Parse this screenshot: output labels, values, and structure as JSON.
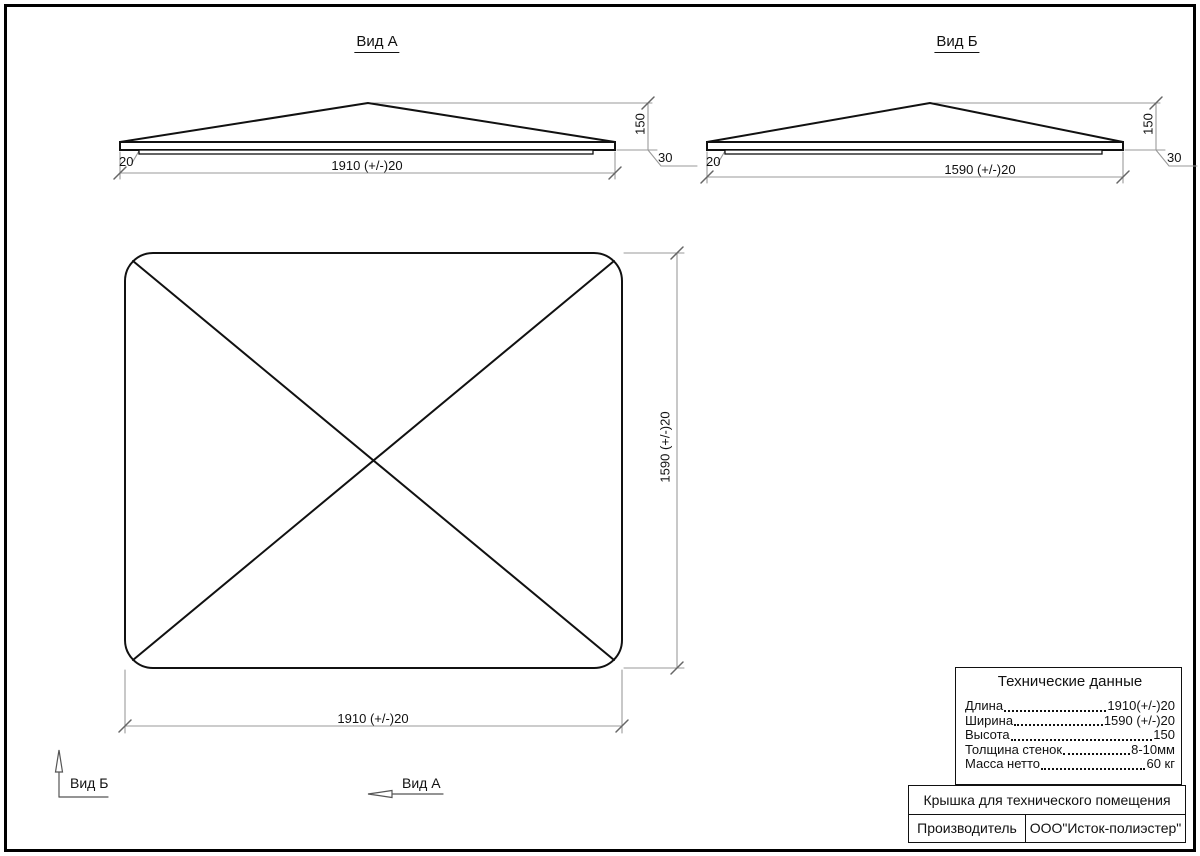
{
  "page": {
    "background": "#ffffff",
    "line_color": "#111111",
    "dim_line_color": "#9a9a9a"
  },
  "views": {
    "view_a": {
      "title": "Вид А",
      "dim_width": "1910 (+/-)20",
      "dim_height": "150",
      "dim_edge": "30",
      "dim_lip": "20"
    },
    "view_b": {
      "title": "Вид Б",
      "dim_width": "1590 (+/-)20",
      "dim_height": "150",
      "dim_edge": "30",
      "dim_lip": "20"
    },
    "plan": {
      "dim_width": "1910 (+/-)20",
      "dim_height": "1590 (+/-)20"
    }
  },
  "view_arrows": {
    "view_b_label": "Вид Б",
    "view_a_label": "Вид А"
  },
  "tech_table": {
    "title": "Технические данные",
    "rows": [
      {
        "label": "Длина",
        "value": "1910(+/-)20"
      },
      {
        "label": "Ширина",
        "value": "1590 (+/-)20"
      },
      {
        "label": "Высота",
        "value": "150"
      },
      {
        "label": "Толщина стенок",
        "value": "8-10мм"
      },
      {
        "label": "Масса нетто ",
        "value": "60 кг"
      }
    ]
  },
  "title_block": {
    "product_name": "Крышка для технического помещения",
    "manufacturer_label": "Производитель",
    "manufacturer_value": "ООО\"Исток-полиэстер\""
  }
}
